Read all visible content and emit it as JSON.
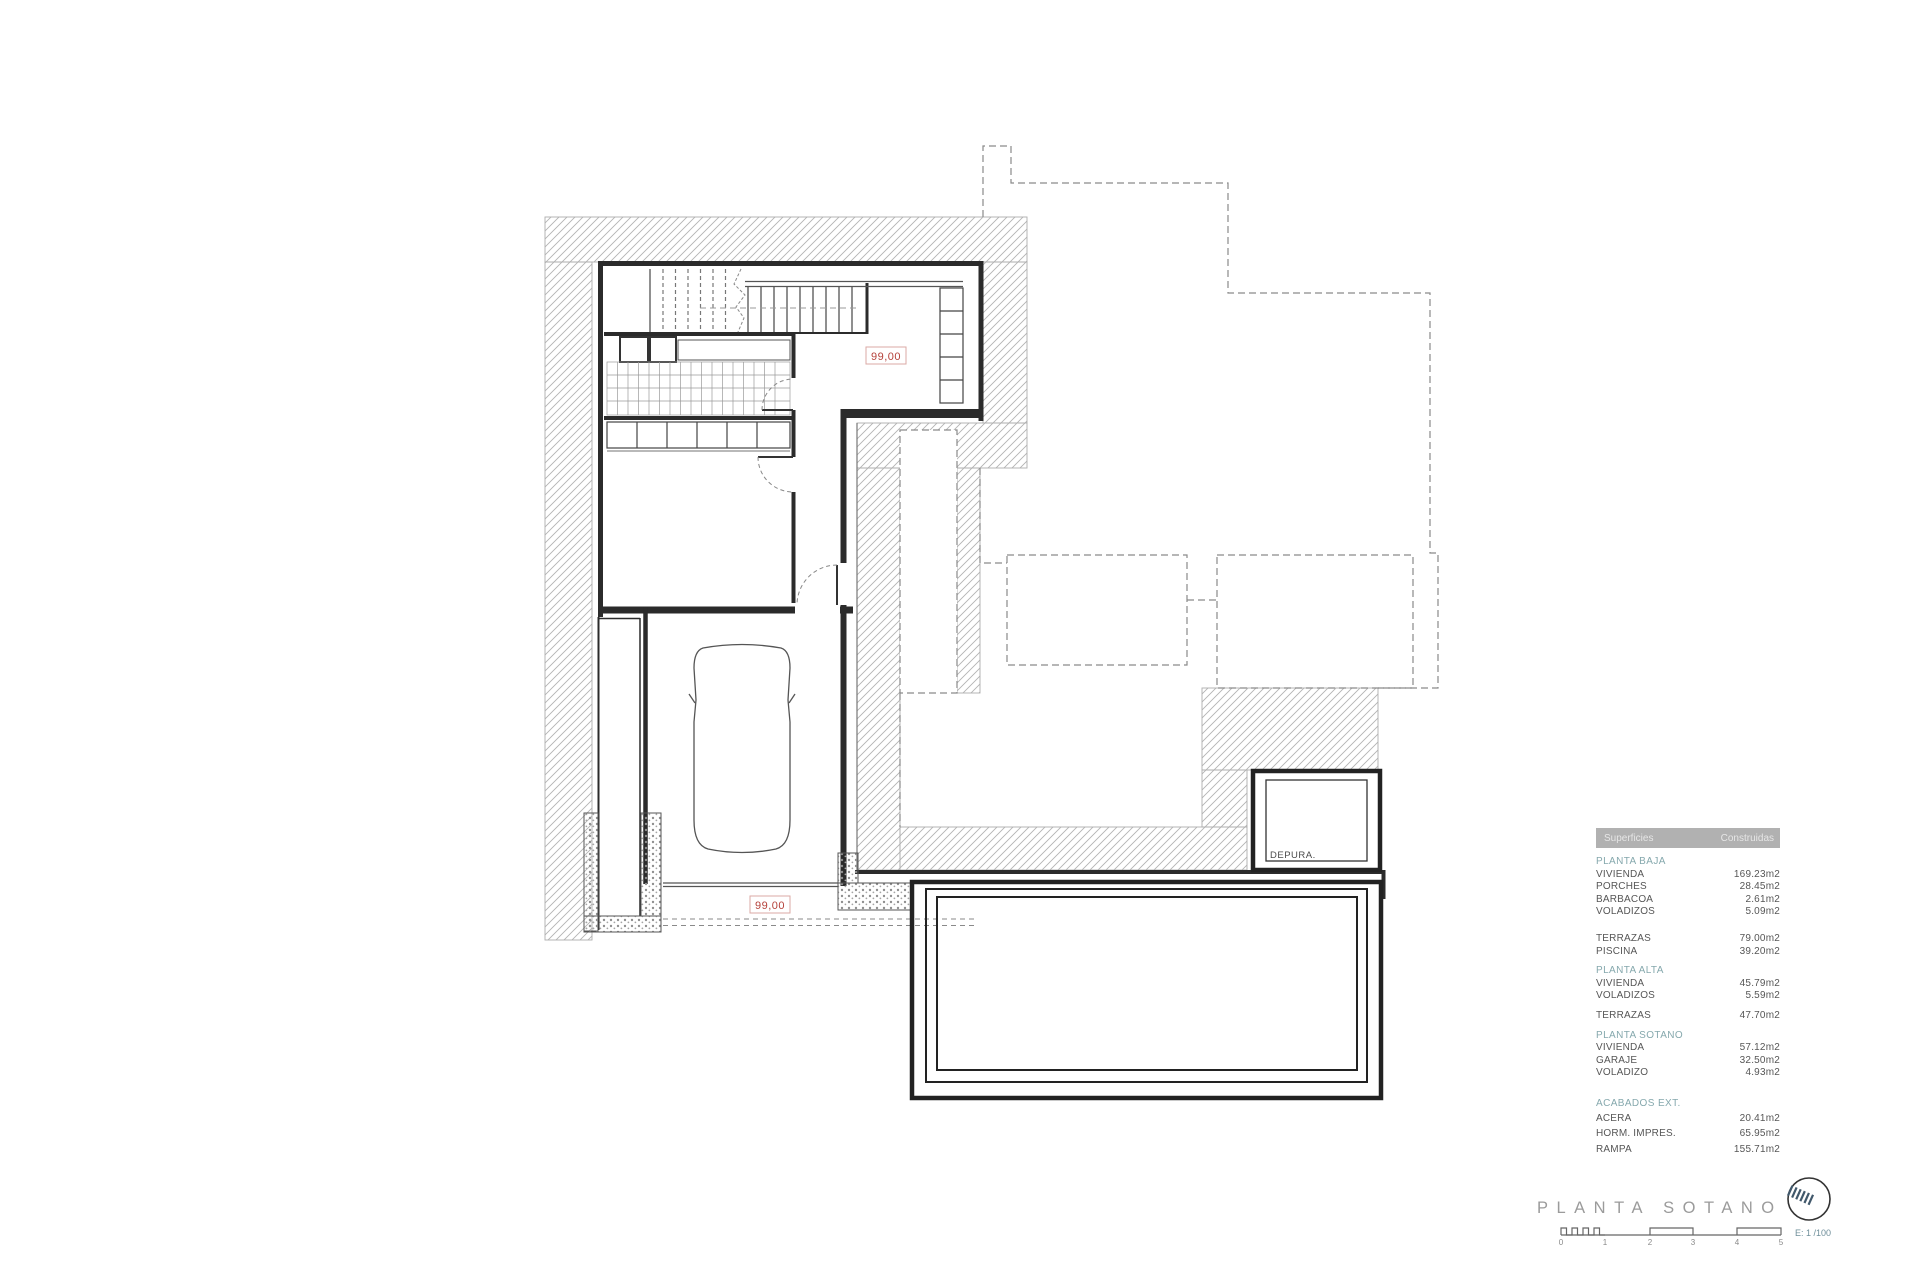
{
  "drawing": {
    "level_label_upper": "99,00",
    "level_label_lower": "99,00",
    "depura_label": "DEPURA."
  },
  "table": {
    "header": {
      "col1": "Superficies",
      "col2": "Construidas"
    },
    "sections": [
      {
        "title": "PLANTA BAJA",
        "rows": [
          {
            "label": "VIVIENDA",
            "value": "169.23m2"
          },
          {
            "label": "PORCHES",
            "value": "28.45m2"
          },
          {
            "label": "BARBACOA",
            "value": "2.61m2"
          },
          {
            "label": "VOLADIZOS",
            "value": "5.09m2"
          }
        ]
      },
      {
        "title": "",
        "rows": [
          {
            "label": "TERRAZAS",
            "value": "79.00m2"
          },
          {
            "label": "PISCINA",
            "value": "39.20m2"
          }
        ]
      },
      {
        "title": "PLANTA ALTA",
        "rows": [
          {
            "label": "VIVIENDA",
            "value": "45.79m2"
          },
          {
            "label": "VOLADIZOS",
            "value": "5.59m2"
          }
        ]
      },
      {
        "title": "",
        "rows": [
          {
            "label": "TERRAZAS",
            "value": "47.70m2"
          }
        ]
      },
      {
        "title": "PLANTA SOTANO",
        "rows": [
          {
            "label": "VIVIENDA",
            "value": "57.12m2"
          },
          {
            "label": "GARAJE",
            "value": "32.50m2"
          },
          {
            "label": "VOLADIZO",
            "value": "4.93m2"
          }
        ]
      },
      {
        "title": "ACABADOS EXT.",
        "rows": [
          {
            "label": "ACERA",
            "value": "20.41m2"
          },
          {
            "label": "HORM. IMPRES.",
            "value": "65.95m2"
          },
          {
            "label": "RAMPA",
            "value": "155.71m2"
          }
        ]
      }
    ]
  },
  "footer": {
    "title": "PLANTA SOTANO",
    "scale_label": "E: 1 /100",
    "ticks": [
      "0",
      "1",
      "2",
      "3",
      "4",
      "5"
    ]
  },
  "colors": {
    "accent_red": "#b5413a",
    "label_box_border": "#dbaaa5",
    "section_teal": "#85a8ad",
    "title_gray": "#9b9b9b",
    "header_bg": "#b1b1b1",
    "line_dark": "#2b2b2b",
    "hatch_gray": "#b3b3b3"
  }
}
